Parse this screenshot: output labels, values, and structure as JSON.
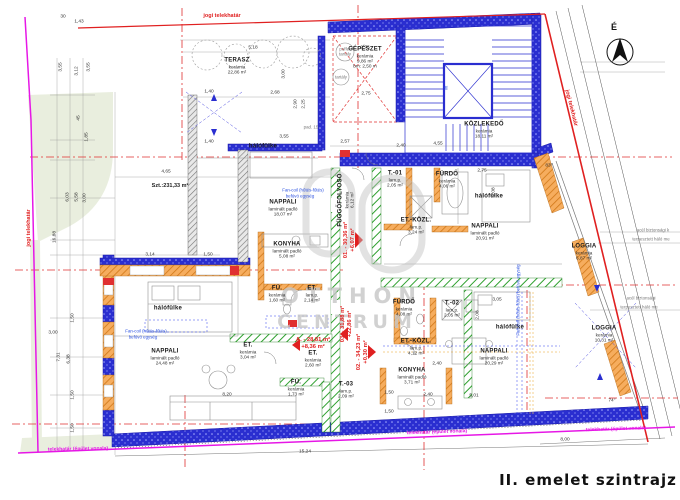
{
  "title": "II. emelet szintrajz",
  "north": "É",
  "site_area": "Szt.:231,33 m²",
  "watermark": {
    "top": "OTTHON",
    "bottom": "CENTRUM"
  },
  "colors": {
    "wall_blue": "#2a2ed0",
    "brick_orange": "#f6ad5e",
    "partition_green": "#2fa12f",
    "axis_red": "#e03030",
    "boundary_red": "#e02020",
    "boundary_magenta": "#e617e6",
    "plot_green": "#e9eede",
    "note_blue": "#2a50e0",
    "watermark_grey": "#c6c6c6"
  },
  "rooms": [
    [
      "TERASZ",
      "kerámia",
      "22,86 m²",
      237,
      66,
      0,
      null
    ],
    [
      "GÉPÉSZET",
      "kerámia",
      "9,86 m²",
      365,
      58,
      0,
      "bm: 2,50 m"
    ],
    [
      "KÖZLEKEDŐ",
      "kerámia",
      "18,11 m²",
      484,
      130,
      0,
      null
    ],
    [
      "FÜGGŐFOLYOSÓ",
      "kerámia",
      "6,12 m²",
      346,
      200,
      -90,
      null
    ],
    [
      "T.-01",
      "lam.p.",
      "2,05 m²",
      395,
      179,
      0,
      null
    ],
    [
      "FÜRDŐ",
      "kerámia",
      "4,06 m²",
      447,
      180,
      0,
      null
    ],
    [
      "hálófülke",
      "",
      "",
      489,
      197,
      0,
      null
    ],
    [
      "ET.-KÖZL.",
      "lam.p.",
      "3,24 m²",
      416,
      226,
      0,
      null
    ],
    [
      "NAPPALI",
      "laminált padló",
      "18,07 m²",
      283,
      208,
      0,
      null
    ],
    [
      "hálófülke",
      "",
      "",
      263,
      147,
      0,
      null
    ],
    [
      "KONYHA",
      "laminált padló",
      "5,08 m²",
      287,
      250,
      0,
      null
    ],
    [
      "FÜ.",
      "kerámia",
      "1,60 m²",
      277,
      294,
      0,
      null
    ],
    [
      "ET.",
      "lam.p.",
      "2,14 m²",
      312,
      294,
      0,
      null
    ],
    [
      "NAPPALI",
      "laminált padló",
      "24,48 m²",
      165,
      357,
      0,
      null
    ],
    [
      "hálófülke",
      "",
      "",
      168,
      309,
      0,
      null
    ],
    [
      "ET.",
      "kerámia",
      "3,04 m²",
      248,
      351,
      0,
      null
    ],
    [
      "FÜ.",
      "kerámia",
      "1,73 m²",
      296,
      388,
      0,
      null
    ],
    [
      "ET.",
      "kerámia",
      "2,60 m²",
      313,
      359,
      0,
      null
    ],
    [
      "T.-03",
      "lam.p.",
      "2,09 m²",
      346,
      390,
      0,
      null
    ],
    [
      "FÜRDŐ",
      "kerámia",
      "4,08 m²",
      404,
      308,
      0,
      null
    ],
    [
      "T.-02",
      "lam.p.",
      "2,05 m²",
      452,
      309,
      0,
      null
    ],
    [
      "ET.-KÖZL.",
      "lam.p.",
      "4,12 m²",
      416,
      347,
      0,
      null
    ],
    [
      "KONYHA",
      "laminált padló",
      "3,71 m²",
      412,
      376,
      0,
      null
    ],
    [
      "NAPPALI",
      "laminált padló",
      "20,29 m²",
      494,
      357,
      0,
      null
    ],
    [
      "hálófülke",
      "",
      "",
      510,
      328,
      0,
      null
    ],
    [
      "NAPPALI",
      "laminált padló",
      "20,91 m²",
      485,
      232,
      0,
      null
    ],
    [
      "LOGGIA",
      "kerámia",
      "6,87 m²",
      584,
      252,
      0,
      null
    ],
    [
      "LOGGIA",
      "kerámia",
      "10,31 m²",
      604,
      334,
      0,
      null
    ]
  ],
  "apartments": [
    [
      "01. - 30,36 m²",
      "+6,07 m²",
      350,
      240,
      -90
    ],
    [
      "03. - 31,88 m²",
      "+22,86 m²",
      347,
      324,
      -90
    ],
    [
      "02. - 34,23 m²",
      "+0,30 m²",
      363,
      352,
      -90
    ],
    [
      "A. - 28,81 m²",
      "+8,36 m²",
      313,
      344,
      0
    ]
  ],
  "dims": [
    [
      "30",
      63,
      17,
      0
    ],
    [
      "1,43",
      79,
      22,
      0
    ],
    [
      "3,55",
      61,
      67,
      -90
    ],
    [
      "3,12",
      77,
      71,
      -90
    ],
    [
      "3,55",
      89,
      67,
      -90
    ],
    [
      "45",
      79,
      118,
      -90
    ],
    [
      "1,85",
      87,
      137,
      -90
    ],
    [
      "16,88",
      55,
      237,
      -90
    ],
    [
      "6,03",
      68,
      197,
      -90
    ],
    [
      "5,58",
      77,
      197,
      -90
    ],
    [
      "3,00",
      85,
      198,
      -90
    ],
    [
      "3,00",
      53,
      333,
      0
    ],
    [
      "7,31",
      59,
      357,
      -90
    ],
    [
      "6,38",
      69,
      359,
      -90
    ],
    [
      "1,50",
      73,
      318,
      -90
    ],
    [
      "1,50",
      73,
      395,
      -90
    ],
    [
      "1,50",
      73,
      428,
      -90
    ],
    [
      "5,18",
      253,
      48,
      0
    ],
    [
      "2,68",
      275,
      93,
      0
    ],
    [
      "1,40",
      209,
      92,
      0
    ],
    [
      "3,00",
      284,
      74,
      -90
    ],
    [
      "2,90",
      296,
      104,
      -90
    ],
    [
      "2,25",
      304,
      104,
      -90
    ],
    [
      "1,40",
      209,
      142,
      0
    ],
    [
      "3,55",
      284,
      137,
      0
    ],
    [
      "4,65",
      166,
      172,
      0
    ],
    [
      "3,14",
      150,
      255,
      0
    ],
    [
      "1,50",
      208,
      255,
      0
    ],
    [
      "2,75",
      365,
      48,
      0
    ],
    [
      "2,75",
      366,
      94,
      0
    ],
    [
      "2,57",
      345,
      142,
      0
    ],
    [
      "2,40",
      401,
      146,
      0
    ],
    [
      "4,55",
      438,
      144,
      0
    ],
    [
      "2,75",
      482,
      171,
      0
    ],
    [
      "2,08",
      494,
      192,
      -90
    ],
    [
      "8,20",
      227,
      395,
      0
    ],
    [
      "2,40",
      428,
      395,
      0
    ],
    [
      "5,01",
      474,
      396,
      0
    ],
    [
      "3,05",
      497,
      300,
      0
    ],
    [
      "2,08",
      478,
      315,
      -90
    ],
    [
      "1,50",
      389,
      393,
      0
    ],
    [
      "1,50",
      389,
      412,
      0
    ],
    [
      "2,40",
      437,
      364,
      0
    ],
    [
      "15,24",
      305,
      452,
      0
    ],
    [
      "8,00",
      565,
      440,
      0
    ],
    [
      "83°",
      549,
      166,
      0
    ],
    [
      "74°",
      612,
      401,
      0
    ]
  ],
  "notes": [
    [
      "jogi telekhatár",
      222,
      16,
      0,
      "red"
    ],
    [
      "jogi telekhatár",
      29,
      228,
      -90,
      "red"
    ],
    [
      "jogi telekhatár",
      571,
      108,
      76,
      "red"
    ],
    [
      "telekhatár (épület vonala)",
      78,
      450,
      -1,
      "mag"
    ],
    [
      "telekhatár (épület vonala)",
      437,
      433,
      -2,
      "mag"
    ],
    [
      "telekhatár (épület vonala)",
      616,
      430,
      -2,
      "mag"
    ],
    [
      "Fan-coil (hűtés-fűtés)",
      303,
      191,
      0,
      "blue"
    ],
    [
      "befúvó egység",
      300,
      197,
      0,
      "blue"
    ],
    [
      "Fan-coil (hűtés-fűtés)",
      146,
      332,
      0,
      "blue"
    ],
    [
      "befúvó egység",
      143,
      338,
      0,
      "blue"
    ],
    [
      "Fan-coil (hűtés-fűtés) befúvó egység",
      519,
      300,
      -90,
      "blue"
    ],
    [
      "acél biztonsági k",
      653,
      231,
      0,
      "grey"
    ],
    [
      "terpesztett háló me",
      651,
      240,
      0,
      "grey"
    ],
    [
      "acél biztonsági",
      641,
      299,
      0,
      "grey"
    ],
    [
      "terpesztett háló me",
      639,
      308,
      0,
      "grey"
    ],
    [
      "puffer",
      345,
      50,
      0,
      "grey"
    ],
    [
      "tartály",
      345,
      55,
      0,
      "grey"
    ],
    [
      "tartály",
      341,
      78,
      0,
      "grey"
    ],
    [
      "pad. 15",
      311,
      128,
      0,
      "grey"
    ],
    [
      "lift",
      447,
      88,
      -90,
      "blue"
    ]
  ]
}
